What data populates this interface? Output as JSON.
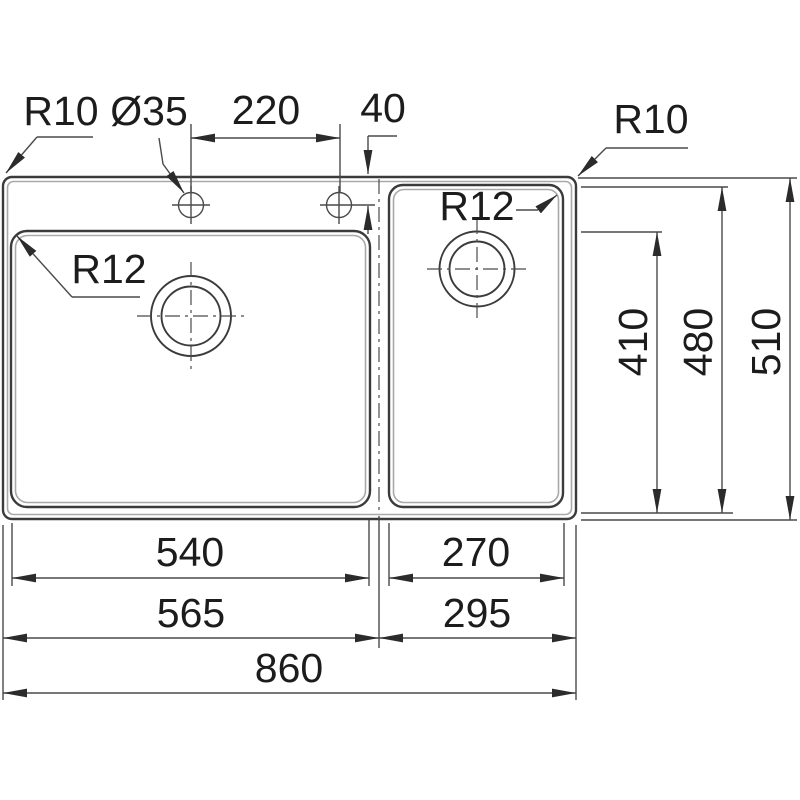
{
  "colors": {
    "background": "#ffffff",
    "line_color": "#3b3b3b",
    "shadow_color": "#a9a9a9",
    "dim_color": "#4a4a4a",
    "text_color": "#1c1c1c"
  },
  "labels": {
    "outer_corner_radius_left": "R10",
    "outer_corner_radius_right": "R10",
    "tap_hole_diameter": "Ø35",
    "left_bowl_corner_radius": "R12",
    "right_bowl_corner_radius": "R12"
  },
  "dimensions": {
    "tap_hole_spacing": "220",
    "tap_hole_offset_from_edge": "40",
    "bowl_depth": "410",
    "right_bowl_outer_depth": "480",
    "overall_depth": "510",
    "left_bowl_width": "540",
    "left_module_width": "565",
    "right_bowl_width": "270",
    "right_module_width": "295",
    "overall_width": "860"
  }
}
